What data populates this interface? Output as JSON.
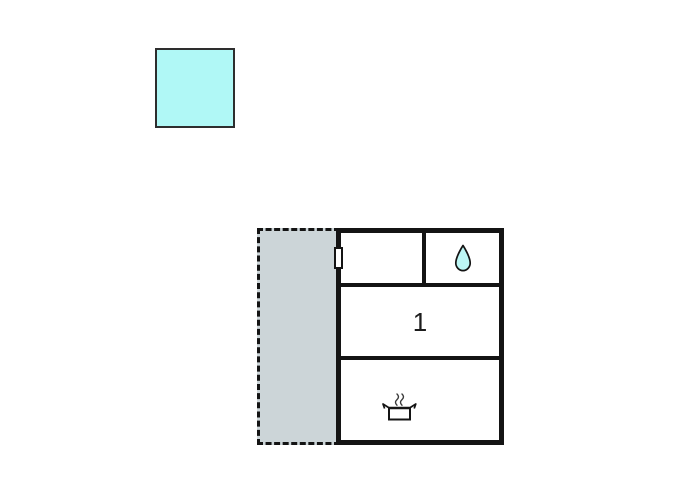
{
  "legend": {
    "swatch": {
      "meaning": "color-key-swatch"
    }
  },
  "floorplan": {
    "annex": {
      "style": "dashed-outline",
      "type": "terrace-area"
    },
    "rooms": {
      "top_left": {
        "label": ""
      },
      "bathroom": {
        "icon": "water-drop-icon"
      },
      "room1": {
        "label": "1"
      },
      "kitchen": {
        "icon": "cooking-pot-icon"
      }
    },
    "door_marker": "door-window-marker"
  },
  "colors": {
    "swatch_fill": "#b0f8f6",
    "swatch_border": "#2e2e2e",
    "wall": "#141414",
    "annex_fill": "#ccd5d8",
    "drop_fill": "#bdf7f5",
    "ink": "#1c1c1c",
    "pot_fill": "#ffffff"
  }
}
